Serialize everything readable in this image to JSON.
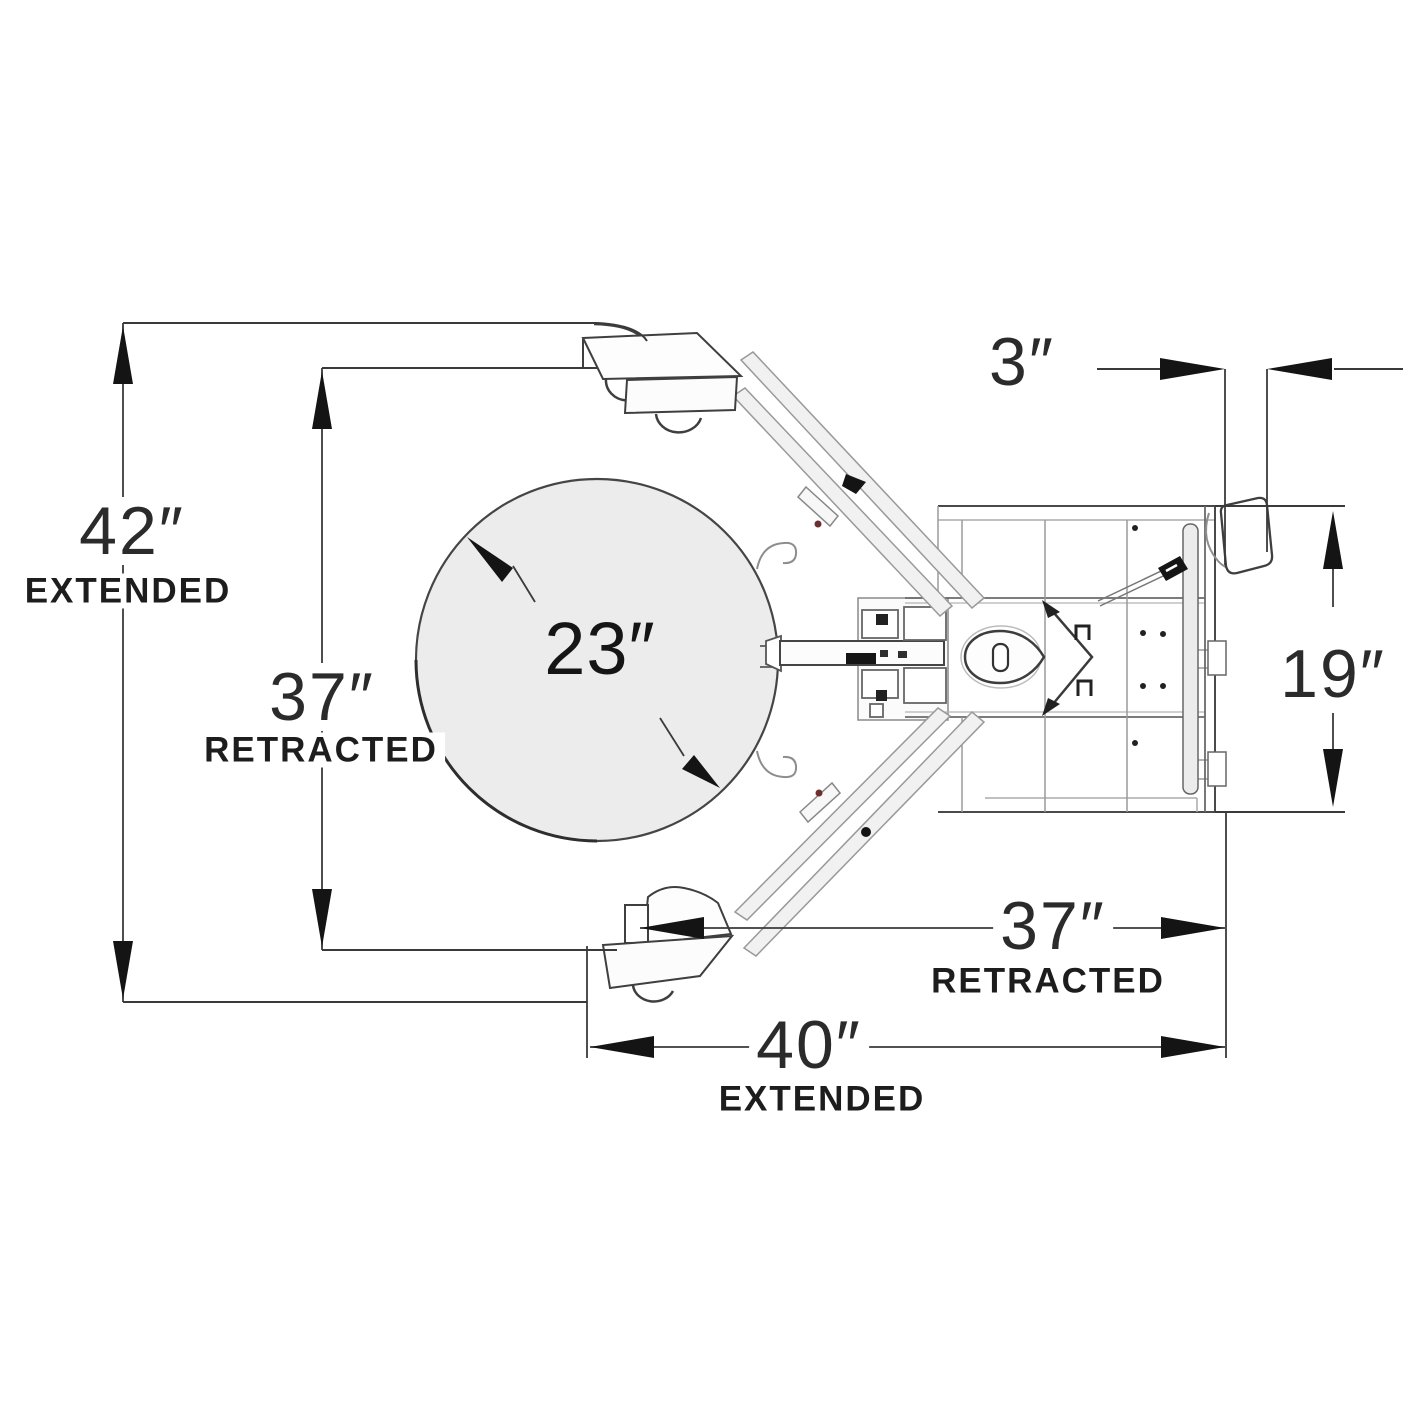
{
  "diagram": {
    "type": "technical-dimension-drawing",
    "subject": "drum grabber attachment, top view",
    "drum": {
      "diameter_label": "23″"
    },
    "dimensions": {
      "width_extended": {
        "value": "42″",
        "word": "EXTENDED"
      },
      "width_retracted": {
        "value": "37″",
        "word": "RETRACTED"
      },
      "caster_offset": {
        "value": "3″"
      },
      "body_width": {
        "value": "19″"
      },
      "length_retracted": {
        "value": "37″",
        "word": "RETRACTED"
      },
      "length_extended": {
        "value": "40″",
        "word": "EXTENDED"
      }
    }
  },
  "colors": {
    "line": "#3a3a3a",
    "machine-line": "#8a8a8a",
    "drum-fill": "#ececec",
    "arrow": "#141414",
    "label": "#222222",
    "bg": "#ffffff"
  }
}
